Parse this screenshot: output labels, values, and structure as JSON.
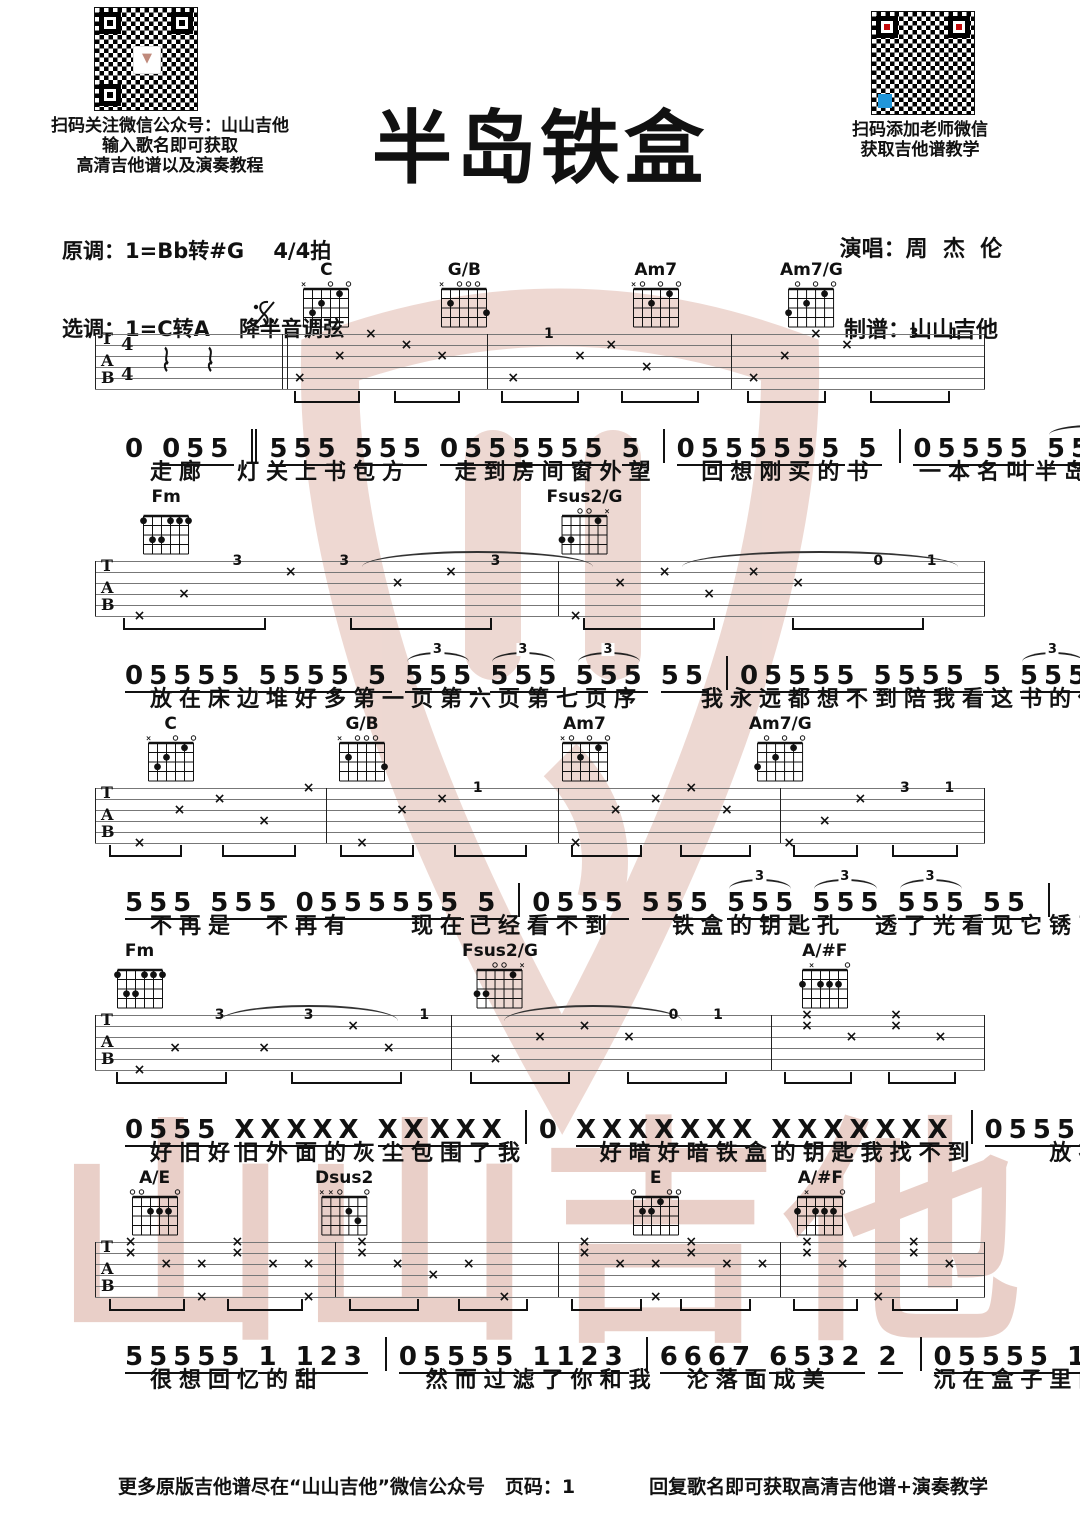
{
  "title": "半岛铁盒",
  "header": {
    "left1": "扫码关注微信公众号：山山吉他",
    "left2": "输入歌名即可获取",
    "left3": "高清吉他谱以及演奏教程",
    "keys1": "原调：1=Bb转#G    4/4拍",
    "keys2": "选调：1=C转A    降半音调弦",
    "right1": "扫码添加老师微信",
    "right2": "获取吉他谱教学",
    "singer": "演唱：周  杰  伦",
    "notator": "制谱：山山吉他"
  },
  "watermark": {
    "text": "山山吉他",
    "color": "#d8a99c"
  },
  "qr_colors": {
    "finder_red": "#c40a0a",
    "module_blue": "#2196d9"
  },
  "chord_shapes": {
    "C": [
      -1,
      3,
      2,
      0,
      1,
      0
    ],
    "G/B": [
      -1,
      2,
      0,
      0,
      0,
      3
    ],
    "Am7": [
      -1,
      0,
      2,
      0,
      1,
      0
    ],
    "Am7/G": [
      3,
      0,
      2,
      0,
      1,
      0
    ],
    "Fm": [
      1,
      3,
      3,
      1,
      1,
      1
    ],
    "Fsus2/G": [
      3,
      3,
      0,
      0,
      1,
      -1
    ],
    "A/#F": [
      2,
      -1,
      2,
      2,
      2,
      0
    ],
    "A/E": [
      0,
      0,
      2,
      2,
      2,
      0
    ],
    "Dsus2": [
      -1,
      -1,
      0,
      2,
      3,
      0
    ],
    "E": [
      0,
      2,
      2,
      1,
      0,
      0
    ]
  },
  "systems": [
    {
      "segno": true,
      "timesig": [
        "4",
        "4"
      ],
      "rests": [
        7.5,
        12.5
      ],
      "chords": [
        {
          "name": "C",
          "x": 26
        },
        {
          "name": "G/B",
          "x": 41.5
        },
        {
          "name": "Am7",
          "x": 63
        },
        {
          "name": "Am7/G",
          "x": 80.5
        }
      ],
      "barlines": [
        {
          "x": 0
        },
        {
          "x": 21,
          "dbl": true
        },
        {
          "x": 44
        },
        {
          "x": 71.5
        },
        {
          "x": 99.9
        }
      ],
      "arcs": [],
      "marks": [
        [
          23,
          4,
          "×"
        ],
        [
          27.5,
          2,
          "×"
        ],
        [
          31,
          0,
          "×"
        ],
        [
          35,
          1,
          "×"
        ],
        [
          39,
          2,
          "×"
        ],
        [
          47,
          4,
          "×"
        ],
        [
          51,
          0,
          "1"
        ],
        [
          54.5,
          2,
          "×"
        ],
        [
          58,
          1,
          "×"
        ],
        [
          62,
          3,
          "×"
        ],
        [
          74,
          4,
          "×"
        ],
        [
          77.5,
          2,
          "×"
        ],
        [
          81,
          0,
          "×"
        ],
        [
          84.5,
          1,
          "×"
        ],
        [
          92,
          0,
          "3"
        ],
        [
          96.5,
          0,
          "1"
        ]
      ],
      "melody": [
        {
          "n": "0",
          "u": false
        },
        {
          "n": "055"
        },
        {
          "sep": "dbl"
        },
        {
          "n": "555"
        },
        {
          "n": "555"
        },
        {
          "n": "0555555"
        },
        {
          "n": "5"
        },
        {
          "sep": "bar"
        },
        {
          "n": "0555555"
        },
        {
          "n": "5"
        },
        {
          "sep": "bar"
        },
        {
          "n": "05555"
        },
        {
          "n": "5555",
          "trip": true
        },
        {
          "sep": "bar"
        }
      ],
      "lyrics": "走廊　灯关上书包方　 走到房间窗外望　 回想刚买的书　 一本名叫半岛铁盒"
    },
    {
      "chords": [
        {
          "name": "Fm",
          "x": 8
        },
        {
          "name": "Fsus2/G",
          "x": 55
        }
      ],
      "barlines": [
        {
          "x": 0
        },
        {
          "x": 52
        },
        {
          "x": 99.9
        }
      ],
      "arcs": [
        [
          30,
          56
        ],
        [
          66,
          97
        ]
      ],
      "marks": [
        [
          5,
          5,
          "×"
        ],
        [
          10,
          3,
          "×"
        ],
        [
          16,
          0,
          "3"
        ],
        [
          22,
          1,
          "×"
        ],
        [
          28,
          0,
          "3"
        ],
        [
          34,
          2,
          "×"
        ],
        [
          40,
          1,
          "×"
        ],
        [
          45,
          0,
          "3"
        ],
        [
          54,
          5,
          "×"
        ],
        [
          59,
          2,
          "×"
        ],
        [
          64,
          1,
          "×"
        ],
        [
          69,
          3,
          "×"
        ],
        [
          74,
          1,
          "×"
        ],
        [
          79,
          2,
          "×"
        ],
        [
          88,
          0,
          "0"
        ],
        [
          94,
          0,
          "1"
        ]
      ],
      "melody": [
        {
          "n": "05555"
        },
        {
          "n": "5555"
        },
        {
          "n": "5"
        },
        {
          "n": "555",
          "trip": true
        },
        {
          "n": "555",
          "trip": true
        },
        {
          "n": "555",
          "trip": true
        },
        {
          "n": "55"
        },
        {
          "sep": "bar"
        },
        {
          "n": "05555"
        },
        {
          "n": "5555"
        },
        {
          "n": "5"
        },
        {
          "n": "555",
          "trip": true
        },
        {
          "n": "555",
          "trip": true
        },
        {
          "n": "555",
          "trip": true
        },
        {
          "n": "55"
        },
        {
          "sep": "bar"
        }
      ],
      "lyrics": "放在床边堆好多第一页第六页第七页序　　我永远都想不到陪我看这书的你会要走"
    },
    {
      "chords": [
        {
          "name": "C",
          "x": 8.5
        },
        {
          "name": "G/B",
          "x": 30
        },
        {
          "name": "Am7",
          "x": 55
        },
        {
          "name": "Am7/G",
          "x": 77
        }
      ],
      "barlines": [
        {
          "x": 0
        },
        {
          "x": 26
        },
        {
          "x": 52
        },
        {
          "x": 77
        },
        {
          "x": 99.9
        }
      ],
      "arcs": [],
      "marks": [
        [
          5,
          5,
          "×"
        ],
        [
          9.5,
          2,
          "×"
        ],
        [
          14,
          1,
          "×"
        ],
        [
          19,
          3,
          "×"
        ],
        [
          24,
          0,
          "×"
        ],
        [
          30,
          5,
          "×"
        ],
        [
          34.5,
          2,
          "×"
        ],
        [
          39,
          1,
          "×"
        ],
        [
          43,
          0,
          "1"
        ],
        [
          54,
          5,
          "×"
        ],
        [
          58.5,
          2,
          "×"
        ],
        [
          63,
          1,
          "×"
        ],
        [
          67,
          0,
          "×"
        ],
        [
          71,
          2,
          "×"
        ],
        [
          78,
          5,
          "×"
        ],
        [
          82,
          3,
          "×"
        ],
        [
          86,
          1,
          "×"
        ],
        [
          91,
          0,
          "3"
        ],
        [
          96,
          0,
          "1"
        ]
      ],
      "melody": [
        {
          "n": "555"
        },
        {
          "n": "555"
        },
        {
          "n": "0555555",
          "u": true
        },
        {
          "n": "5"
        },
        {
          "sep": "bar"
        },
        {
          "n": "0555"
        },
        {
          "n": "555"
        },
        {
          "n": "555",
          "trip": true
        },
        {
          "n": "555",
          "trip": true
        },
        {
          "n": "555",
          "trip": true
        },
        {
          "n": "55"
        },
        {
          "sep": "bar"
        }
      ],
      "lyrics": "不再是　不再有　　现在已经看不到　　铁盒的钥匙孔　透了光看见它锈了好久"
    },
    {
      "chords": [
        {
          "name": "Fm",
          "x": 5
        },
        {
          "name": "Fsus2/G",
          "x": 45.5
        },
        {
          "name": "A/#F",
          "x": 82
        }
      ],
      "barlines": [
        {
          "x": 0
        },
        {
          "x": 40
        },
        {
          "x": 76
        },
        {
          "x": 99.9
        }
      ],
      "arcs": [
        [
          14,
          34
        ],
        [
          46,
          66
        ]
      ],
      "marks": [
        [
          5,
          5,
          "×"
        ],
        [
          9,
          3,
          "×"
        ],
        [
          14,
          0,
          "3"
        ],
        [
          19,
          3,
          "×"
        ],
        [
          24,
          0,
          "3"
        ],
        [
          29,
          1,
          "×"
        ],
        [
          33,
          3,
          "×"
        ],
        [
          37,
          0,
          "1"
        ],
        [
          45,
          4,
          "×"
        ],
        [
          50,
          2,
          "×"
        ],
        [
          55,
          1,
          "×"
        ],
        [
          60,
          2,
          "×"
        ],
        [
          65,
          0,
          "0"
        ],
        [
          70,
          0,
          "1"
        ],
        [
          80,
          0,
          "×"
        ],
        [
          80,
          1,
          "×"
        ],
        [
          85,
          2,
          "×"
        ],
        [
          90,
          0,
          "×"
        ],
        [
          90,
          1,
          "×"
        ],
        [
          95,
          2,
          "×"
        ]
      ],
      "melody": [
        {
          "n": "0555"
        },
        {
          "n": "XXXXX"
        },
        {
          "n": "XXXXX"
        },
        {
          "sep": "bar"
        },
        {
          "n": "0",
          "u": false
        },
        {
          "n": "XXXXXXX"
        },
        {
          "n": "XXXXXXX"
        },
        {
          "sep": "bar"
        },
        {
          "n": "05555"
        },
        {
          "n": "1123"
        },
        {
          "sep": "bar"
        }
      ],
      "lyrics": "好旧好旧外面的灰尘包围了我　　 好暗好暗铁盒的钥匙我找不到　　 放在糖果旁的是我"
    },
    {
      "chords": [
        {
          "name": "A/E",
          "x": 6.7
        },
        {
          "name": "Dsus2",
          "x": 28
        },
        {
          "name": "E",
          "x": 63
        },
        {
          "name": "A/#F",
          "x": 81.5
        }
      ],
      "barlines": [
        {
          "x": 0
        },
        {
          "x": 27
        },
        {
          "x": 52
        },
        {
          "x": 77
        },
        {
          "x": 99.9
        }
      ],
      "arcs": [],
      "marks": [
        [
          4,
          0,
          "×"
        ],
        [
          4,
          1,
          "×"
        ],
        [
          8,
          2,
          "×"
        ],
        [
          12,
          2,
          "×"
        ],
        [
          12,
          5,
          "×"
        ],
        [
          16,
          0,
          "×"
        ],
        [
          16,
          1,
          "×"
        ],
        [
          20,
          2,
          "×"
        ],
        [
          24,
          2,
          "×"
        ],
        [
          24,
          5,
          "×"
        ],
        [
          30,
          0,
          "×"
        ],
        [
          30,
          1,
          "×"
        ],
        [
          34,
          2,
          "×"
        ],
        [
          38,
          3,
          "×"
        ],
        [
          42,
          2,
          "×"
        ],
        [
          46,
          5,
          "×"
        ],
        [
          55,
          0,
          "×"
        ],
        [
          55,
          1,
          "×"
        ],
        [
          59,
          2,
          "×"
        ],
        [
          63,
          2,
          "×"
        ],
        [
          63,
          5,
          "×"
        ],
        [
          67,
          0,
          "×"
        ],
        [
          67,
          1,
          "×"
        ],
        [
          71,
          2,
          "×"
        ],
        [
          75,
          2,
          "×"
        ],
        [
          80,
          0,
          "×"
        ],
        [
          80,
          1,
          "×"
        ],
        [
          84,
          2,
          "×"
        ],
        [
          88,
          5,
          "×"
        ],
        [
          92,
          0,
          "×"
        ],
        [
          92,
          1,
          "×"
        ],
        [
          96,
          2,
          "×"
        ]
      ],
      "melody": [
        {
          "n": "55555"
        },
        {
          "n": "1"
        },
        {
          "n": "123"
        },
        {
          "sep": "bar"
        },
        {
          "n": "05555"
        },
        {
          "n": "1123"
        },
        {
          "sep": "bar"
        },
        {
          "n": "6667"
        },
        {
          "n": "6532"
        },
        {
          "n": "2"
        },
        {
          "sep": "bar"
        },
        {
          "n": "05555"
        },
        {
          "n": "1123"
        },
        {
          "sep": "bar"
        }
      ],
      "lyrics": "很想回忆的甜　　　 然而过滤了你和我　沦落面成美　　　 沉在盒子里的是你"
    }
  ],
  "footer": {
    "left": "更多原版吉他谱尽在“山山吉他”微信公众号",
    "page": "页码：1",
    "right": "回复歌名即可获取高清吉他谱+演奏教学"
  }
}
